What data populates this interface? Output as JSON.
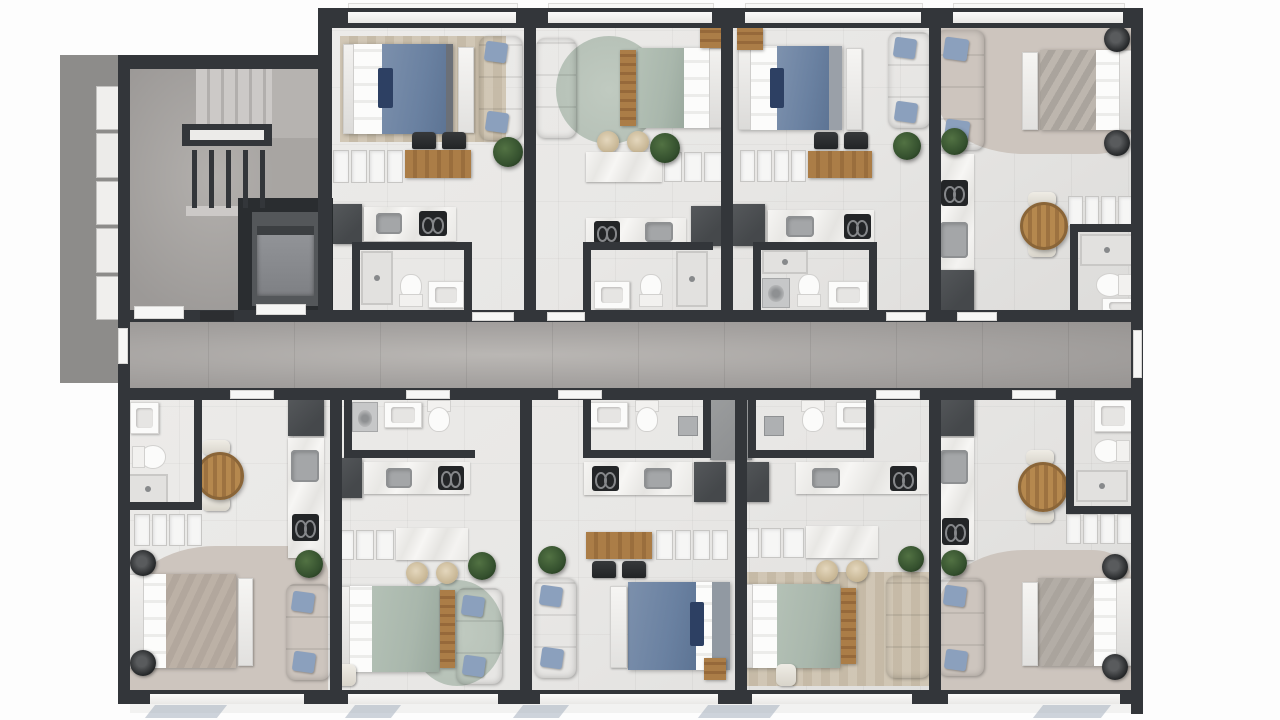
{
  "image": {
    "kind": "architectural floor plan",
    "style": "top-down 3D render, furnished",
    "visible_text": ""
  },
  "palette": {
    "wall": "#33363a",
    "concrete": "#8d8c8a",
    "stair_floor": "#9c9997",
    "corridor_floor": "#a5a2a0",
    "unit_floor": "#e8e7e5",
    "taupe_floor": "#cdc5be",
    "marble": "#f3f2f0",
    "cabinet": "#f6f6f5",
    "dark_box": "#45484b",
    "black": "#232527",
    "wood": "#ab7d47",
    "bed_blue": "#6a81a1",
    "bed_navy": "#2d4063",
    "bed_sage": "#a9b7ac",
    "bed_taupe": "#b2a79d",
    "bed_gray": "#aaa49d",
    "sofa_cream": "#eae7e2",
    "sofa_gray": "#d6d5d3",
    "pillow_blue": "#8ba0bd",
    "plant": "#34502e",
    "rug_beige": "#cfc4b1",
    "rug_sage": "#b7c2b8",
    "fixture": "#fbfbfa",
    "glass": "#9daaba"
  },
  "core": {
    "stairwell": "two-flight staircase with landing and guard rail",
    "elevator": "single elevator cab opening to corridor",
    "corridor": "central double-loaded corridor, grey tile",
    "entry": "west entrance beside mailboxes on concrete pad"
  },
  "units": [
    {
      "id": "top-1",
      "name": "Unit 1 (top row) — studio, navy-blue bed, striped beige rug, cream sofa",
      "bed": "navy-blue"
    },
    {
      "id": "top-2",
      "name": "Unit 2 (top row) — studio, sage-green bed, round sage rug, cream sofa",
      "bed": "sage-green"
    },
    {
      "id": "top-3",
      "name": "Unit 3 (top row) — studio, navy-blue bed, grey sofa",
      "bed": "navy-blue"
    },
    {
      "id": "top-4",
      "name": "Unit 4 (top row, corner) — studio, grey-taupe bed, round dining table",
      "bed": "grey-taupe"
    },
    {
      "id": "bottom-1",
      "name": "Unit 5 (bottom row, corner) — studio, taupe bed, round dining table",
      "bed": "taupe"
    },
    {
      "id": "bottom-2",
      "name": "Unit 6 (bottom row) — studio, sage-green bed, round sage rug",
      "bed": "sage-green"
    },
    {
      "id": "bottom-3",
      "name": "Unit 7 (bottom row) — studio, navy-blue bed, grey sofa",
      "bed": "navy-blue"
    },
    {
      "id": "bottom-4",
      "name": "Unit 8 (bottom row) — studio, sage-green bed, striped beige rug",
      "bed": "sage-green"
    },
    {
      "id": "bottom-5",
      "name": "Unit 9 (bottom row, corner) — studio, grey bed, round dining table",
      "bed": "grey"
    }
  ]
}
